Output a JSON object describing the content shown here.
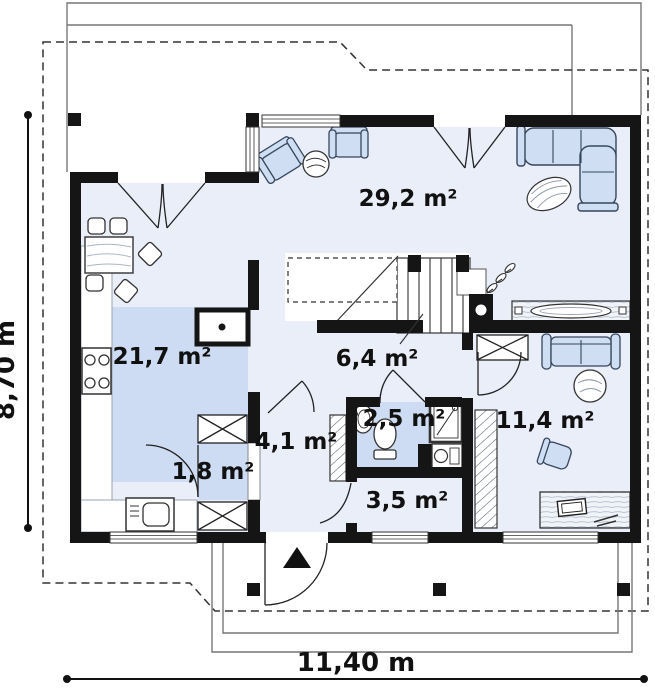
{
  "plan": {
    "type": "floor-plan",
    "rooms": [
      {
        "name": "living-room",
        "label": "29,2 m²"
      },
      {
        "name": "kitchen",
        "label": "21,7 m²"
      },
      {
        "name": "hall-upper",
        "label": "6,4 m²"
      },
      {
        "name": "entry-hall",
        "label": "4,1 m²"
      },
      {
        "name": "bathroom",
        "label": "2,5 m²"
      },
      {
        "name": "pantry",
        "label": "1,8 m²"
      },
      {
        "name": "corridor",
        "label": "3,5 m²"
      },
      {
        "name": "bedroom",
        "label": "11,4 m²"
      }
    ],
    "dimensions": {
      "height_label": "8,70 m",
      "width_label": "11,40 m"
    },
    "colors": {
      "wall": "#151515",
      "floor": "#e9eef9",
      "floor_shaded": "#cddcf2",
      "furniture": "#cfdef2",
      "thin_line": "#777777",
      "background": "#ffffff"
    }
  }
}
